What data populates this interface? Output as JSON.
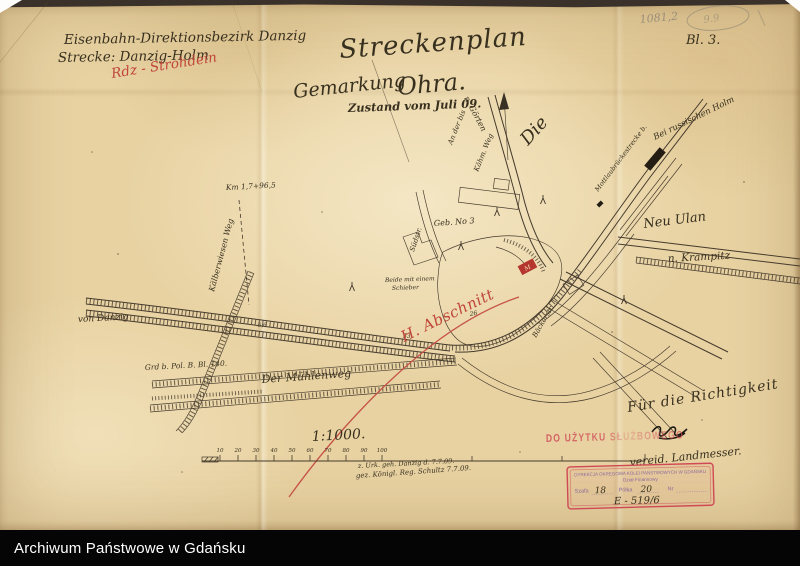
{
  "header": {
    "district_line1": "Eisenbahn-Direktionsbezirk Danzig",
    "district_line2": "Strecke: Danzig-Holm",
    "red_route_note": "Rdz - Strohdein",
    "title": "Streckenplan",
    "subtitle_word": "Gemarkung",
    "subtitle_name": "Ohra.",
    "status_line": "Zustand vom Juli 09.",
    "pencil_number": "1081,2",
    "pencil_circled": "9.9",
    "sheet_number": "Bl. 3."
  },
  "map": {
    "labels": {
      "direction_goerten": "n. Görten",
      "die_script": "Die",
      "road_note_1": "An der bis",
      "road_note_2": "Kähm. Weg",
      "km_mark": "Km 1,7+96,5",
      "kaelberwiesen_weg": "Kälberwiesen Weg",
      "von_danzig": "von Danzig",
      "ground_note": "Grd b. Pol. B. Bl. 140.",
      "muehlenweg": "Der  Mühlenweg",
      "building_no3": "Geb. No 3",
      "schieber_line1": "Beide mit einem",
      "schieber_line2": "Schieber",
      "suedstrasse": "Südstr.",
      "mottlau_line": "Mottlaubrückestrecke b.",
      "holm_direction": "Bei russischen Holm",
      "neu_ulan": "Neu Ulan",
      "krampitz_direction": "n. Krampitz",
      "baeckerstrasse": "Bäckerstr.",
      "mark_26": "26",
      "mark_33": "33",
      "mark_56": "5,6"
    },
    "red_annotations": {
      "abschnitt": "H. Abschnitt",
      "box_mark": "M"
    },
    "scale": {
      "ratio": "1:1000.",
      "ticks": [
        "10",
        "20",
        "30",
        "40",
        "50",
        "60",
        "70",
        "80",
        "90",
        "100"
      ],
      "certify_line1": "z. Urk. geh. Danzig d. 7.7.09.",
      "certify_line2": "gez. Königl. Reg. Schultz 7.7.09."
    },
    "signatures": {
      "richtigkeit": "Für die Richtigkeit",
      "landmesser": "vereid. Landmesser."
    }
  },
  "stamps": {
    "do_uzytku": "DO UŻYTKU SŁUŻBOWEGO",
    "box_line1": "DYREKCJA OKRĘGOWA KOLEI PAŃSTWOWYCH W GDAŃSKU",
    "box_line2": "Dział Finansowy",
    "field_szafa_label": "Szafa",
    "field_szafa_value": "18",
    "field_polka_label": "Półka",
    "field_polka_value": "20",
    "field_nr_label": "Nr",
    "handwritten_ref": "E - 519/6"
  },
  "footer": {
    "archive_name": "Archiwum Państwowe w Gdańsku"
  },
  "colors": {
    "paper": "#e8d2a2",
    "ink": "#3a3126",
    "red_ink": "#c0453a",
    "pencil": "#9b8e79",
    "stamp_red": "#cf4a55",
    "stamp_purple": "#7d5a9d",
    "footer_bg": "#050505"
  }
}
